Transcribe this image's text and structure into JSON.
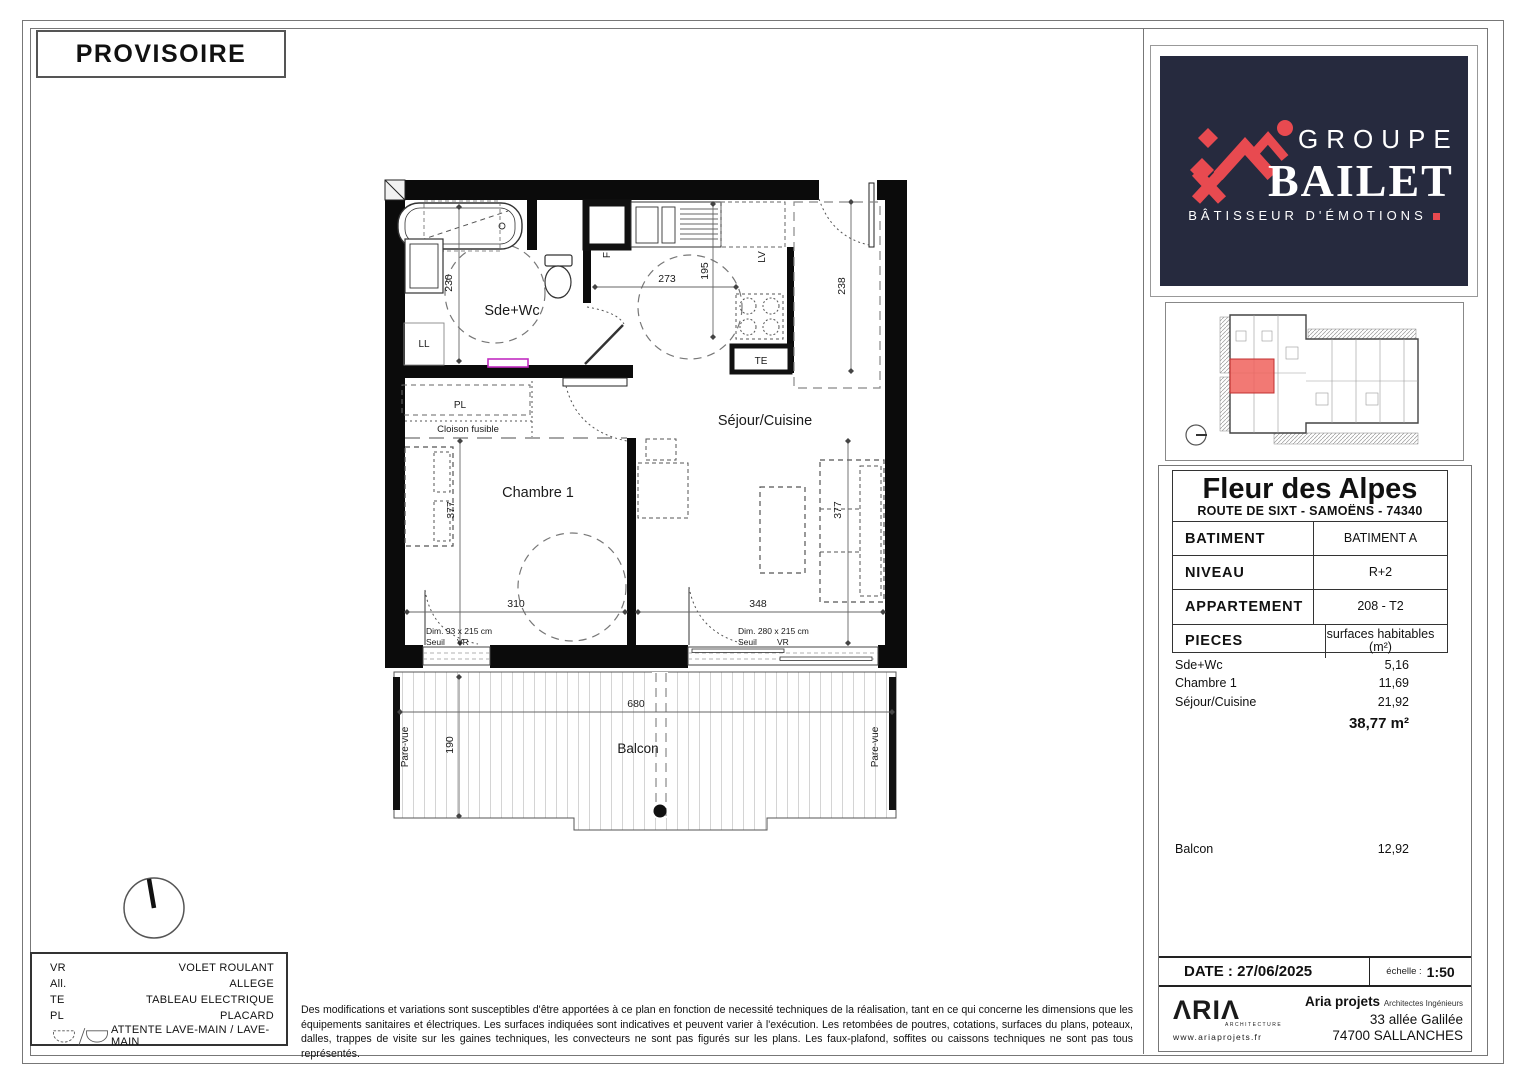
{
  "sheet": {
    "provisoire": "PROVISOIRE"
  },
  "plan": {
    "rooms": {
      "bath": "Sde+Wc",
      "living": "Séjour/Cuisine",
      "bedroom": "Chambre 1",
      "balcony": "Balcon"
    },
    "tags": {
      "ll": "LL",
      "pl": "PL",
      "te": "TE",
      "f": "F",
      "lv": "LV",
      "cloison": "Cloison fusible",
      "pare_vue_left": "Pare-vue",
      "pare_vue_right": "Pare-vue"
    },
    "dims": {
      "bath": "230",
      "kitchen_w": "273",
      "kitchen_d": "195",
      "entry": "238",
      "bedroom_d": "377",
      "bedroom_w": "310",
      "living_d": "377",
      "living_w": "348",
      "balcony_w": "680",
      "balcony_d": "190"
    },
    "window_bedroom": {
      "dim": "Dim. 93 x 215 cm",
      "seuil": "Seuil",
      "vr": "VR"
    },
    "window_living": {
      "dim": "Dim. 280 x 215 cm",
      "seuil": "Seuil",
      "vr": "VR"
    }
  },
  "legend": {
    "items": [
      {
        "abbr": "VR",
        "label": "VOLET ROULANT"
      },
      {
        "abbr": "All.",
        "label": "ALLEGE"
      },
      {
        "abbr": "TE",
        "label": "TABLEAU ELECTRIQUE"
      },
      {
        "abbr": "PL",
        "label": "PLACARD"
      },
      {
        "abbr": "",
        "label": "ATTENTE LAVE-MAIN / LAVE-MAIN"
      }
    ]
  },
  "disclaimer": "Des modifications et variations sont susceptibles d'être apportées à ce plan en fonction de necessité techniques de la réalisation, tant en ce qui concerne les dimensions que les équipements sanitaires et électriques. Les surfaces indiquées sont indicatives et peuvent varier à l'exécution. Les retombées de poutres, cotations, surfaces du plans, poteaux, dalles, trappes de visite sur les gaines techniques, les convecteurs ne sont pas figurés sur les plans. Les faux-plafond, soffites ou caissons techniques ne sont pas tous représentés.",
  "brand": {
    "groupe": "GROUPE",
    "bailet": "BAILET",
    "tagline": "BÂTISSEUR D'ÉMOTIONS",
    "navy": "#262a3e",
    "red": "#e84a50"
  },
  "overview": {
    "highlight": "#f0615c"
  },
  "project": {
    "title": "Fleur des Alpes",
    "address": "ROUTE DE SIXT - SAMOËNS - 74340",
    "rows": [
      {
        "label": "BATIMENT",
        "value": "BATIMENT A"
      },
      {
        "label": "NIVEAU",
        "value": "R+2"
      },
      {
        "label": "APPARTEMENT",
        "value": "208 - T2"
      },
      {
        "label": "PIECES",
        "value": "surfaces habitables (m²)"
      }
    ]
  },
  "areas": {
    "rows": [
      {
        "label": "Sde+Wc",
        "value": "5,16"
      },
      {
        "label": "Chambre 1",
        "value": "11,69"
      },
      {
        "label": "Séjour/Cuisine",
        "value": "21,92"
      }
    ],
    "total": "38,77 m²",
    "balcony_label": "Balcon",
    "balcony_value": "12,92"
  },
  "footer": {
    "date_label": "DATE :",
    "date_value": "27/06/2025",
    "scale_label": "échelle :",
    "scale_value": "1:50",
    "logo_text": "ΛRIΛ",
    "logo_sub": "ARCHITECTURE",
    "logo_url": "www.ariaprojets.fr",
    "company": "Aria projets",
    "company_role": "Architectes Ingénieurs",
    "company_addr1": "33 allée Galilée",
    "company_addr2": "74700 SALLANCHES",
    "green": "#9cb83b"
  }
}
